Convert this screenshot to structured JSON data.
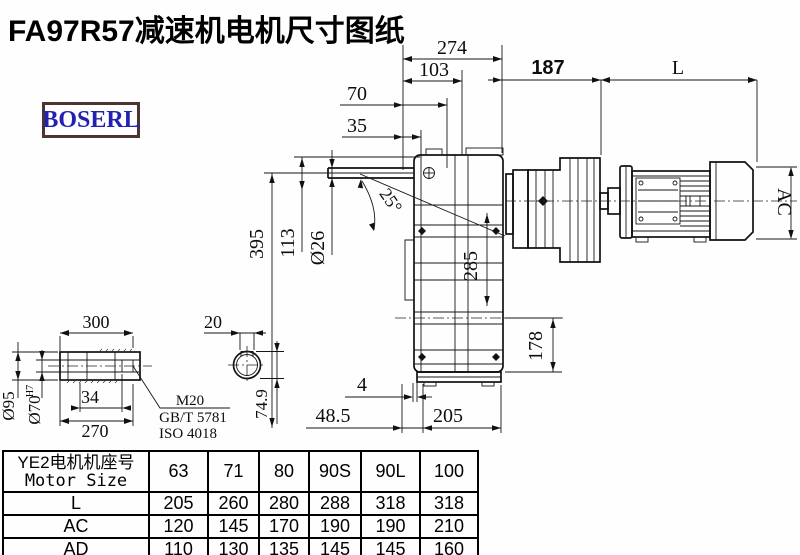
{
  "title": "FA97R57减速机电机尺寸图纸",
  "logo": {
    "text": "BOSERL"
  },
  "colors": {
    "title": "#000000",
    "logo_text": "#2222b2",
    "logo_border": "#4c3430",
    "line": "#111111",
    "background": "#fefefe"
  },
  "drawing": {
    "dims": {
      "w274": "274",
      "w103": "103",
      "w70": "70",
      "w35": "35",
      "l187": "187",
      "lenL": "L",
      "ac": "AC",
      "h395": "395",
      "h113": "113",
      "d26": "Ø26",
      "angle": "25°",
      "h285": "285",
      "h178": "178",
      "b4": "4",
      "b485": "48.5",
      "b205": "205",
      "s300": "300",
      "s270": "270",
      "s34": "34",
      "s20": "20",
      "d95": "Ø95",
      "d70": "Ø70",
      "d70sup": "H7",
      "h749": "74.9",
      "m20": "M20",
      "gb": "GB/T 5781",
      "iso": "ISO 4018"
    }
  },
  "table": {
    "size_label_cn": "YE2电机机座号",
    "size_label_en": "Motor Size",
    "sizes": [
      "63",
      "71",
      "80",
      "90S",
      "90L",
      "100"
    ],
    "rows": [
      {
        "label": "L",
        "values": [
          "205",
          "260",
          "280",
          "288",
          "318",
          "318"
        ]
      },
      {
        "label": "AC",
        "values": [
          "120",
          "145",
          "170",
          "190",
          "190",
          "210"
        ]
      },
      {
        "label": "AD",
        "values": [
          "110",
          "130",
          "135",
          "145",
          "145",
          "160"
        ]
      }
    ]
  }
}
